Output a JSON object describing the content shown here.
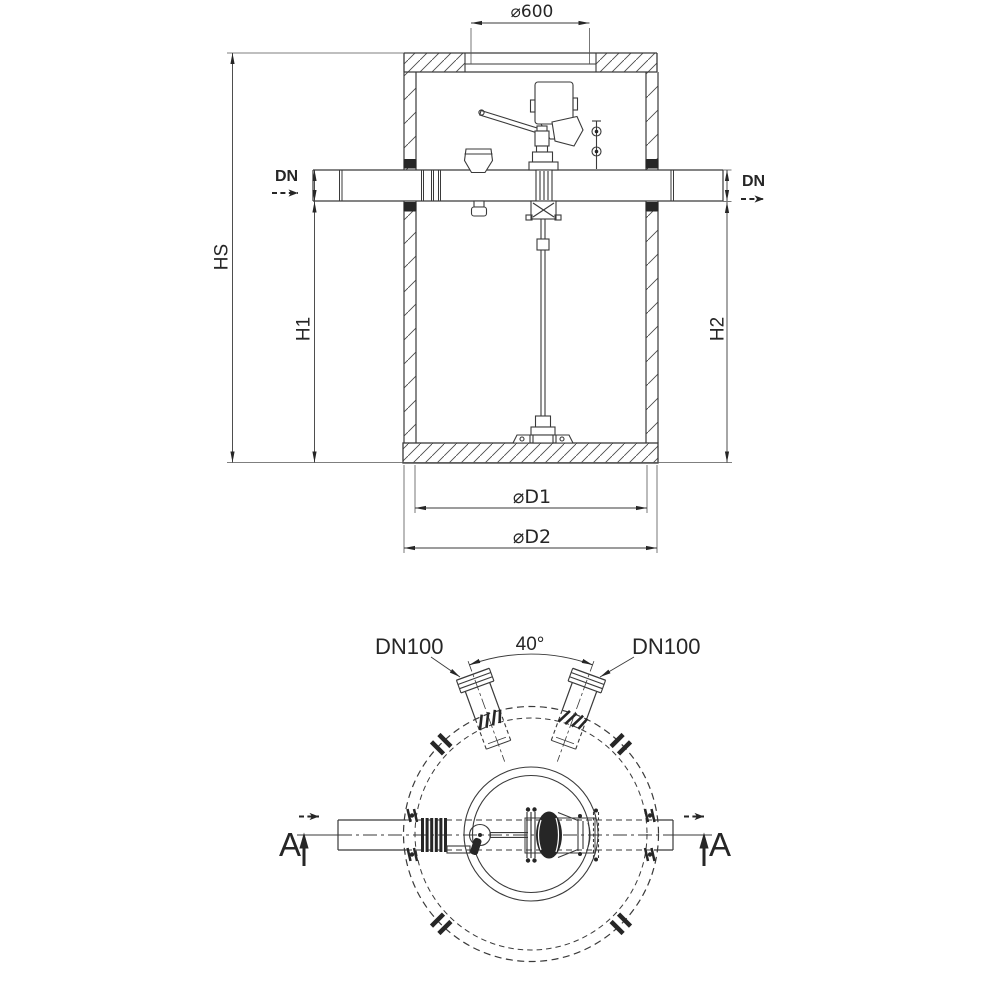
{
  "drawing": {
    "background": "#ffffff",
    "line_color": "#3a3a3a",
    "dark_fill": "#262626",
    "section_view": {
      "labels": {
        "opening_diameter": "⌀600",
        "dn_inlet": "DN",
        "dn_outlet": "DN",
        "height_overall": "HS",
        "height_inlet": "H1",
        "height_outlet": "H2",
        "diameter_inner": "⌀D1",
        "diameter_outer": "⌀D2"
      }
    },
    "plan_view": {
      "labels": {
        "nozzle_left": "DN100",
        "nozzle_right": "DN100",
        "nozzle_angle": "40°",
        "section_cut_left": "A",
        "section_cut_right": "A"
      }
    }
  }
}
